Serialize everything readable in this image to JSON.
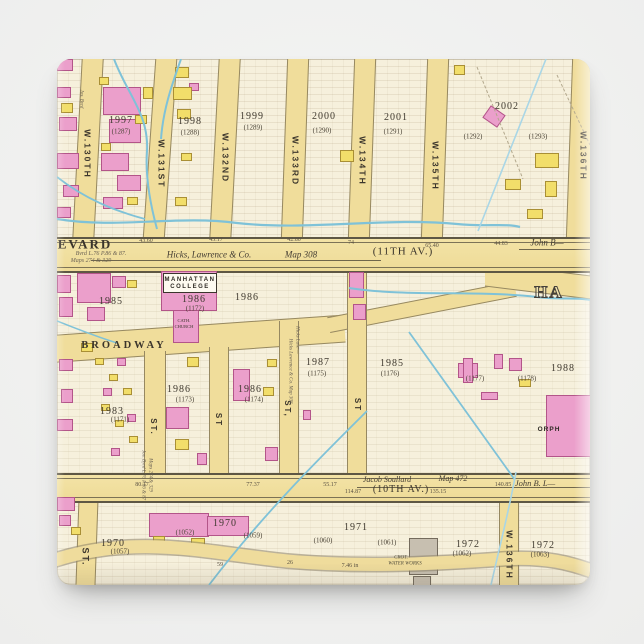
{
  "top": {
    "streets": [
      "W.130TH",
      "W.131ST",
      "W.132ND",
      "W.133RD",
      "W.134TH",
      "W.135TH",
      "W.136TH"
    ],
    "blocks": [
      {
        "num": "1997",
        "ward": "(1287)"
      },
      {
        "num": "1998",
        "ward": "(1288)"
      },
      {
        "num": "1999",
        "ward": "(1289)"
      },
      {
        "num": "2000",
        "ward": "(1290)"
      },
      {
        "num": "2001",
        "ward": "(1291)"
      },
      {
        "num": "2002",
        "ward": "(1292)"
      }
    ],
    "extra_ward": "(1293)",
    "annotation": "Jos. Byrd"
  },
  "boulevard": {
    "name_partial": "EVARD",
    "deed": "Bvrd L.76 P.86 & 87.",
    "maps_ref": "Maps 274 & 329",
    "surveyor": "Hicks, Lawrence & Co.",
    "map_no": "Map 308",
    "avenue": "(11TH AV.)",
    "owner": "John B—",
    "measures": [
      "43.60",
      "45.17",
      "42.80",
      "74",
      "65.40",
      "44.83"
    ]
  },
  "college": {
    "line1": "MANHATTAN",
    "line2": "COLLEGE",
    "block": "1986",
    "ward": "(1172)",
    "church_line1": "CATH.",
    "church_line2": "CHURCH"
  },
  "broadway_label": "BROADWAY",
  "district_partial": "HA",
  "mid": {
    "blocks": [
      {
        "num": "1985",
        "ward": ""
      },
      {
        "num": "1986",
        "ward": ""
      },
      {
        "num": "1986",
        "ward": "(1173)"
      },
      {
        "num": "1986",
        "ward": "(1174)"
      },
      {
        "num": "1983",
        "ward": "(1171)"
      },
      {
        "num": "1987",
        "ward": "(1175)"
      },
      {
        "num": "1985",
        "ward": "(1176)"
      },
      {
        "num": "",
        "ward": "(1177)"
      },
      {
        "num": "",
        "ward": "(1178)"
      },
      {
        "num": "1988",
        "ward": ""
      }
    ],
    "orphan_partial": "ORPH",
    "street_stubs": [
      "ST.",
      "ST",
      "ST,",
      "ST",
      "ST."
    ],
    "side_note": "Hicks Lawrence & Co. Map 308",
    "side_note2": "Jos. Byrd L.76 P.86 & 87",
    "side_note3": "Maps 274 & 329",
    "side_note4": "Hicks Lawr—"
  },
  "tenth": {
    "owner_left": "Jacob Soullard",
    "avenue": "(10TH AV.)",
    "map_no": "Map 472",
    "owner_right": "John B. L—",
    "measures": [
      "80.17",
      "77.37",
      "55.17",
      "114.87",
      "135.15",
      "140.85"
    ]
  },
  "bottom": {
    "blocks": [
      {
        "num": "1970",
        "ward": "(1057)"
      },
      {
        "num": "1970",
        "ward": "(1052)"
      },
      {
        "num": "",
        "ward": "(1059)"
      },
      {
        "num": "",
        "ward": "(1060)"
      },
      {
        "num": "1971",
        "ward": "(1061)"
      },
      {
        "num": "1972",
        "ward": "(1062)"
      },
      {
        "num": "1972",
        "ward": "(1063)"
      }
    ],
    "street": "W.136TH",
    "waterworks_line1": "CROT.",
    "waterworks_line2": "WATER WORKS",
    "road_numbers": [
      "59",
      "26",
      "7.46 in"
    ]
  }
}
